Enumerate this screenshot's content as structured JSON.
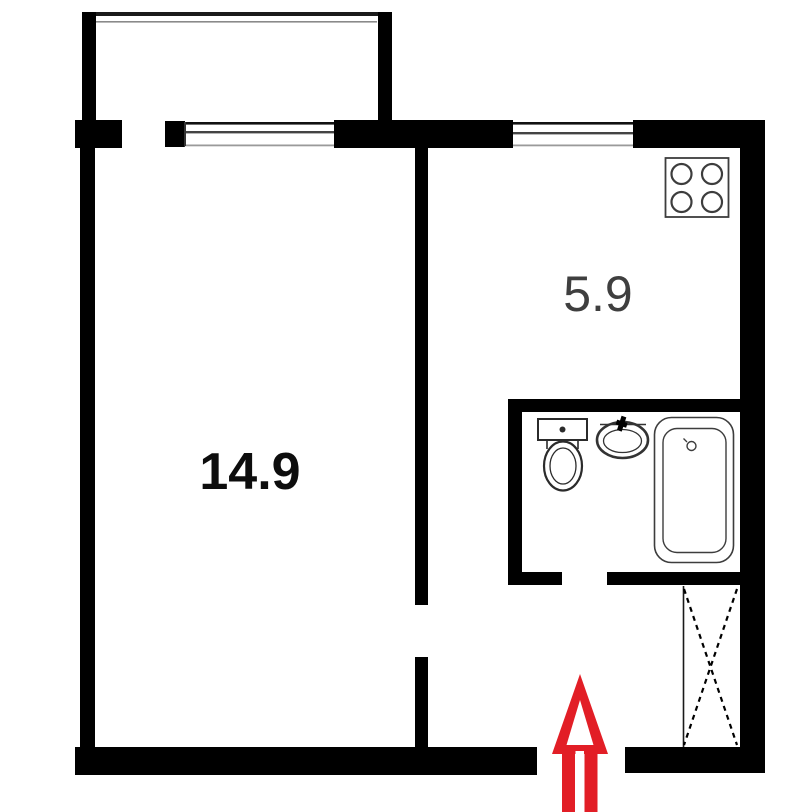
{
  "plan": {
    "type": "apartment-floor-plan",
    "rooms": {
      "living_room": {
        "area_label": "14.9"
      },
      "kitchen": {
        "area_label": "5.9"
      }
    },
    "features": [
      "balcony",
      "living-room-window",
      "kitchen-window",
      "stove-icon",
      "toilet-icon",
      "sink-icon",
      "bathtub-icon",
      "wardrobe-hatch",
      "entrance-arrow-icon"
    ]
  },
  "colors": {
    "wall": "#000000",
    "fixture_stroke": "#3d3d3d",
    "window_inner_line": "#444444",
    "window_faint_line": "#9a9a9a",
    "entrance_arrow": "#e21e26",
    "living_room_label": "#0d0d0d",
    "kitchen_label": "#3f3f3f"
  }
}
